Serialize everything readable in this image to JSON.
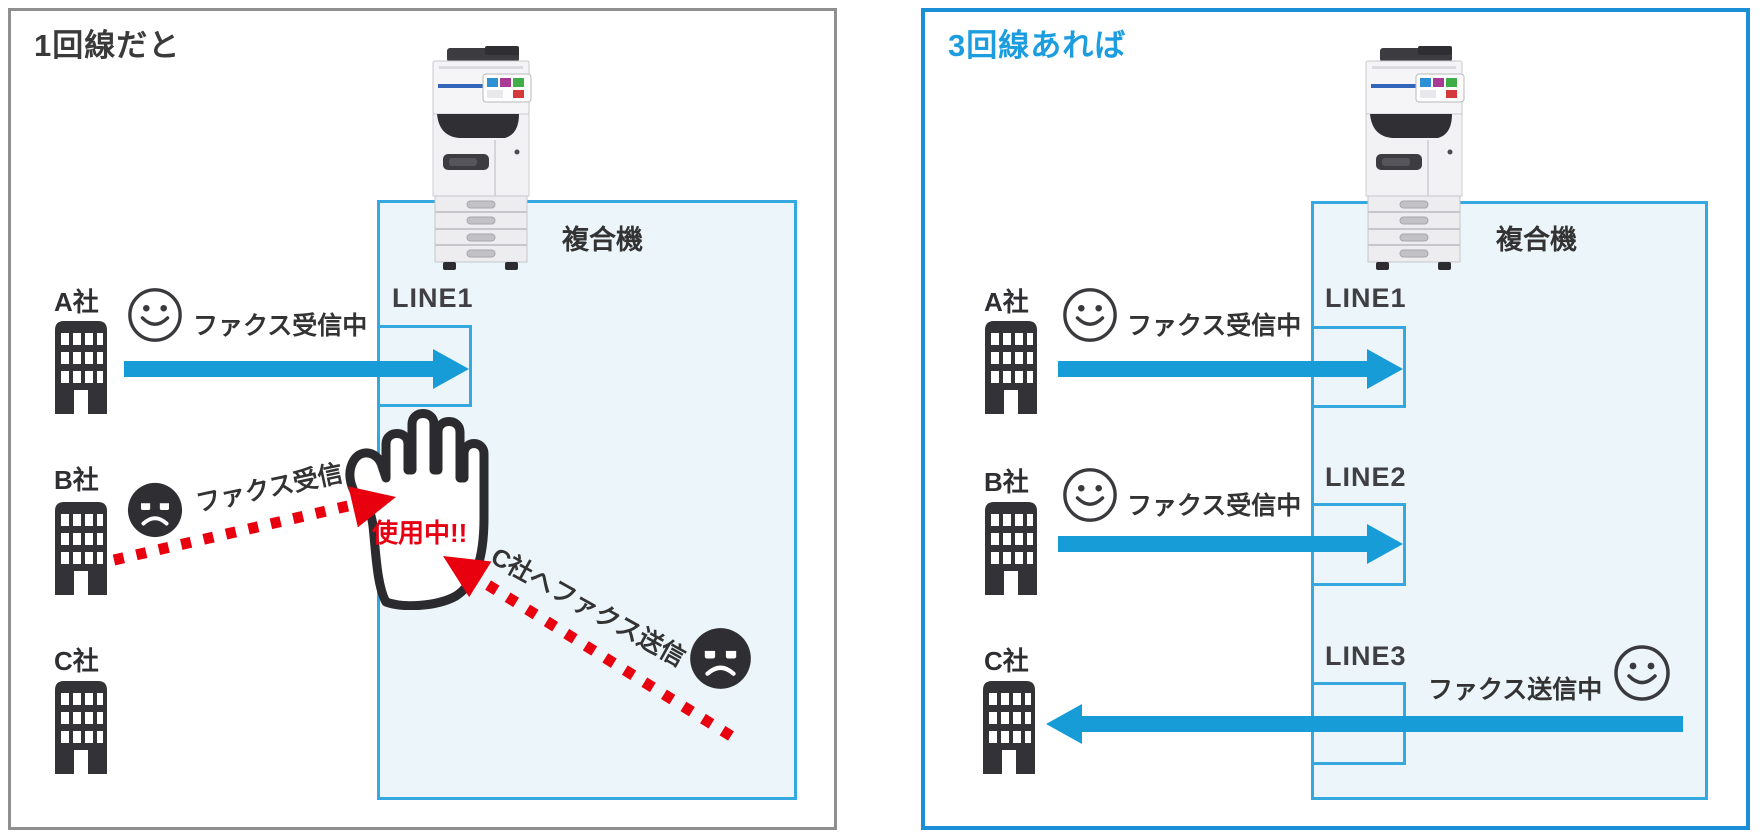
{
  "colors": {
    "blue_accent": "#1b9de0",
    "arrow_blue": "#189cd8",
    "alert_red": "#e60012",
    "box_fill": "#ecf5fa",
    "box_border": "#35a9df",
    "panel_gray_border": "#8f8f8f",
    "text_dark": "#333333"
  },
  "left": {
    "title": "1回線だと",
    "machine_label": "複合機",
    "line1_label": "LINE1",
    "company_a": {
      "name": "A社",
      "status": "ファクス受信中",
      "mood": "happy"
    },
    "company_b": {
      "name": "B社",
      "status": "ファクス受信",
      "mood": "sad"
    },
    "company_c": {
      "name": "C社"
    },
    "busy_label": "使用中!!",
    "send_to_c_label": "C社へファクス送信",
    "send_to_c_mood": "sad"
  },
  "right": {
    "title": "3回線あれば",
    "machine_label": "複合機",
    "rows": [
      {
        "company": "A社",
        "line": "LINE1",
        "status": "ファクス受信中",
        "mood": "happy",
        "direction": "to-machine"
      },
      {
        "company": "B社",
        "line": "LINE2",
        "status": "ファクス受信中",
        "mood": "happy",
        "direction": "to-machine"
      },
      {
        "company": "C社",
        "line": "LINE3",
        "status": "ファクス送信中",
        "mood": "happy",
        "direction": "to-company"
      }
    ]
  }
}
